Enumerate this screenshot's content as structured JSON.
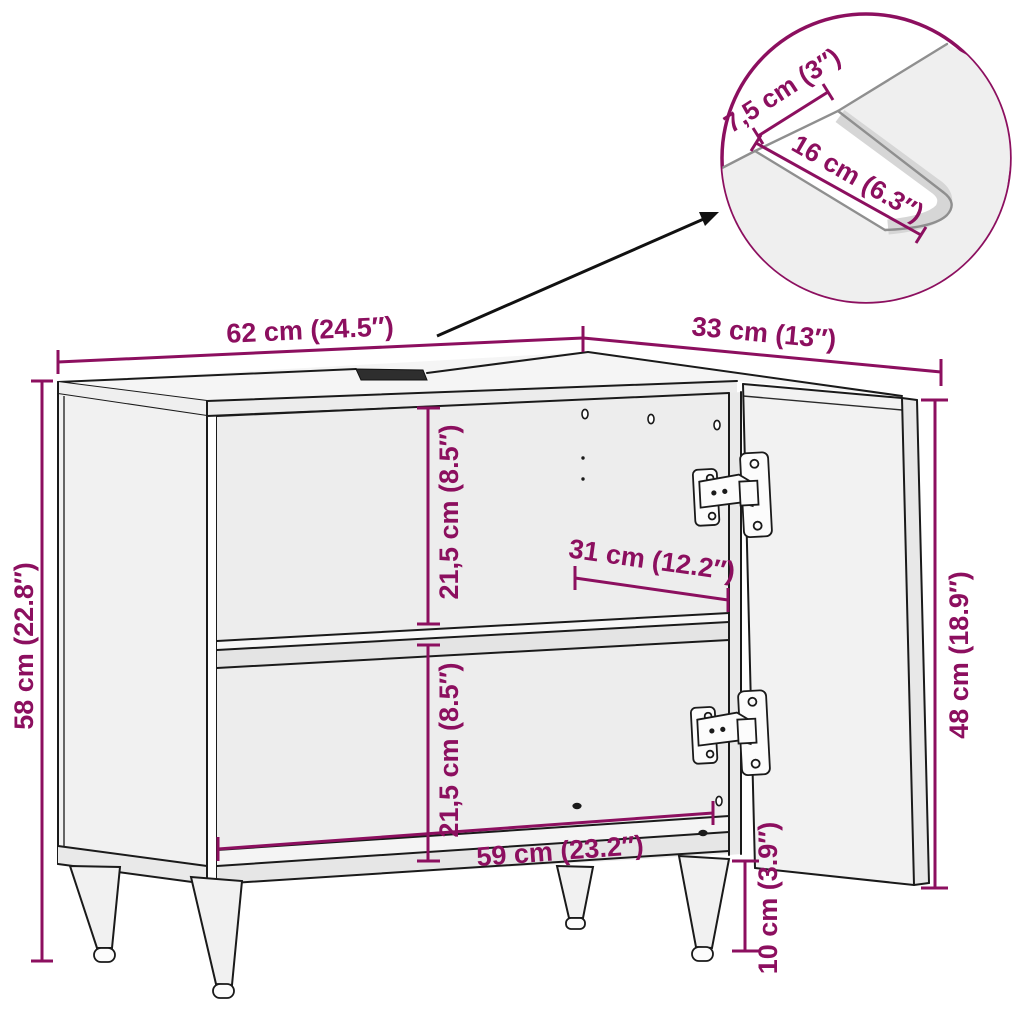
{
  "diagram": {
    "subject": "bathroom sink cabinet dimension diagram",
    "accent_color": "#8C0F5F",
    "line_color": "#1A1A1A",
    "panel_fill": "#F1F1F1",
    "labels": {
      "width": "62 cm (24.5″)",
      "depth": "33 cm (13″)",
      "height": "58 cm (22.8″)",
      "upper_compartment_height": "21,5 cm (8.5″)",
      "lower_compartment_height": "21,5 cm (8.5″)",
      "shelf_width": "31 cm (12.2″)",
      "bottom_interior_width": "59 cm (23.2″)",
      "door_height": "48 cm (18.9″)",
      "leg_height": "10 cm (3.9″)"
    },
    "detail": {
      "cutout_offset": "7,5 cm (3″)",
      "cutout_length": "16 cm (6.3″)"
    }
  }
}
